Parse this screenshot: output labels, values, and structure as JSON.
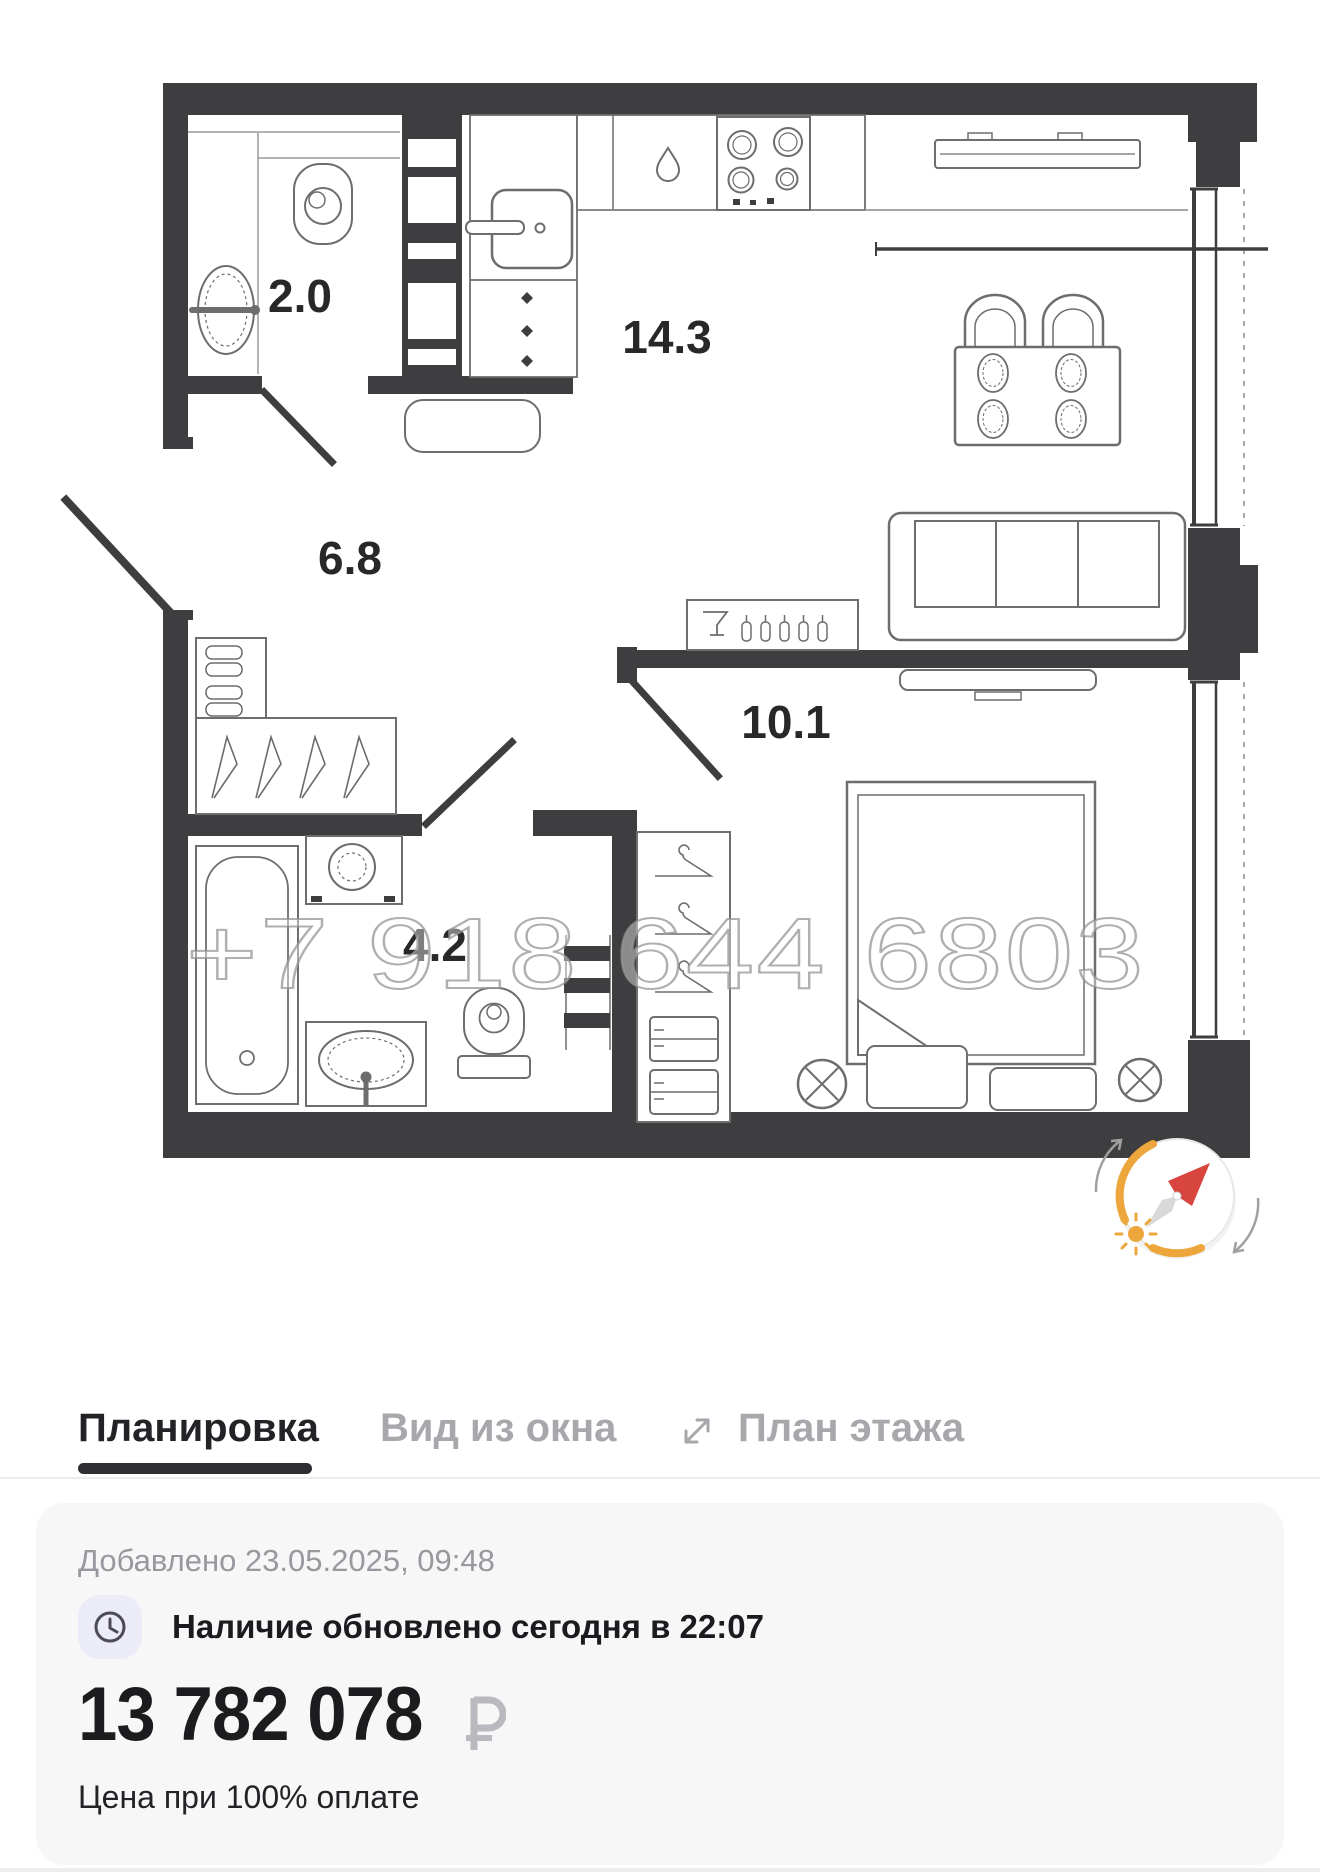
{
  "floor_plan": {
    "watermark": "+7 918 644 6803",
    "rooms": [
      {
        "id": "wc",
        "area": "2.0"
      },
      {
        "id": "hallway",
        "area": "6.8"
      },
      {
        "id": "kitchen_living",
        "area": "14.3"
      },
      {
        "id": "bedroom",
        "area": "10.1"
      },
      {
        "id": "bathroom",
        "area": "4.2"
      }
    ],
    "icons": [
      "compass-icon",
      "sun-icon"
    ]
  },
  "tabs": {
    "items": [
      {
        "label": "Планировка",
        "active": true
      },
      {
        "label": "Вид из окна",
        "active": false
      },
      {
        "label": "План этажа",
        "active": false,
        "icon": "expand-icon"
      }
    ]
  },
  "card": {
    "added": "Добавлено 23.05.2025, 09:48",
    "availability": "Наличие обновлено сегодня в 22:07",
    "price": "13 782 078",
    "currency_symbol": "₽",
    "price_note": "Цена при 100% оплате"
  },
  "colors": {
    "wall": "#3e3e40",
    "furniture_line": "#6d6d6d",
    "active_tab": "#232327",
    "inactive_tab": "#a7a7ac",
    "underline": "#2f2f33",
    "card_bg": "#f7f7f8",
    "icon_bg": "#ecebf8",
    "compass_orange": "#eda63b",
    "compass_red": "#d8453e",
    "watermark_gray": "#949494"
  }
}
